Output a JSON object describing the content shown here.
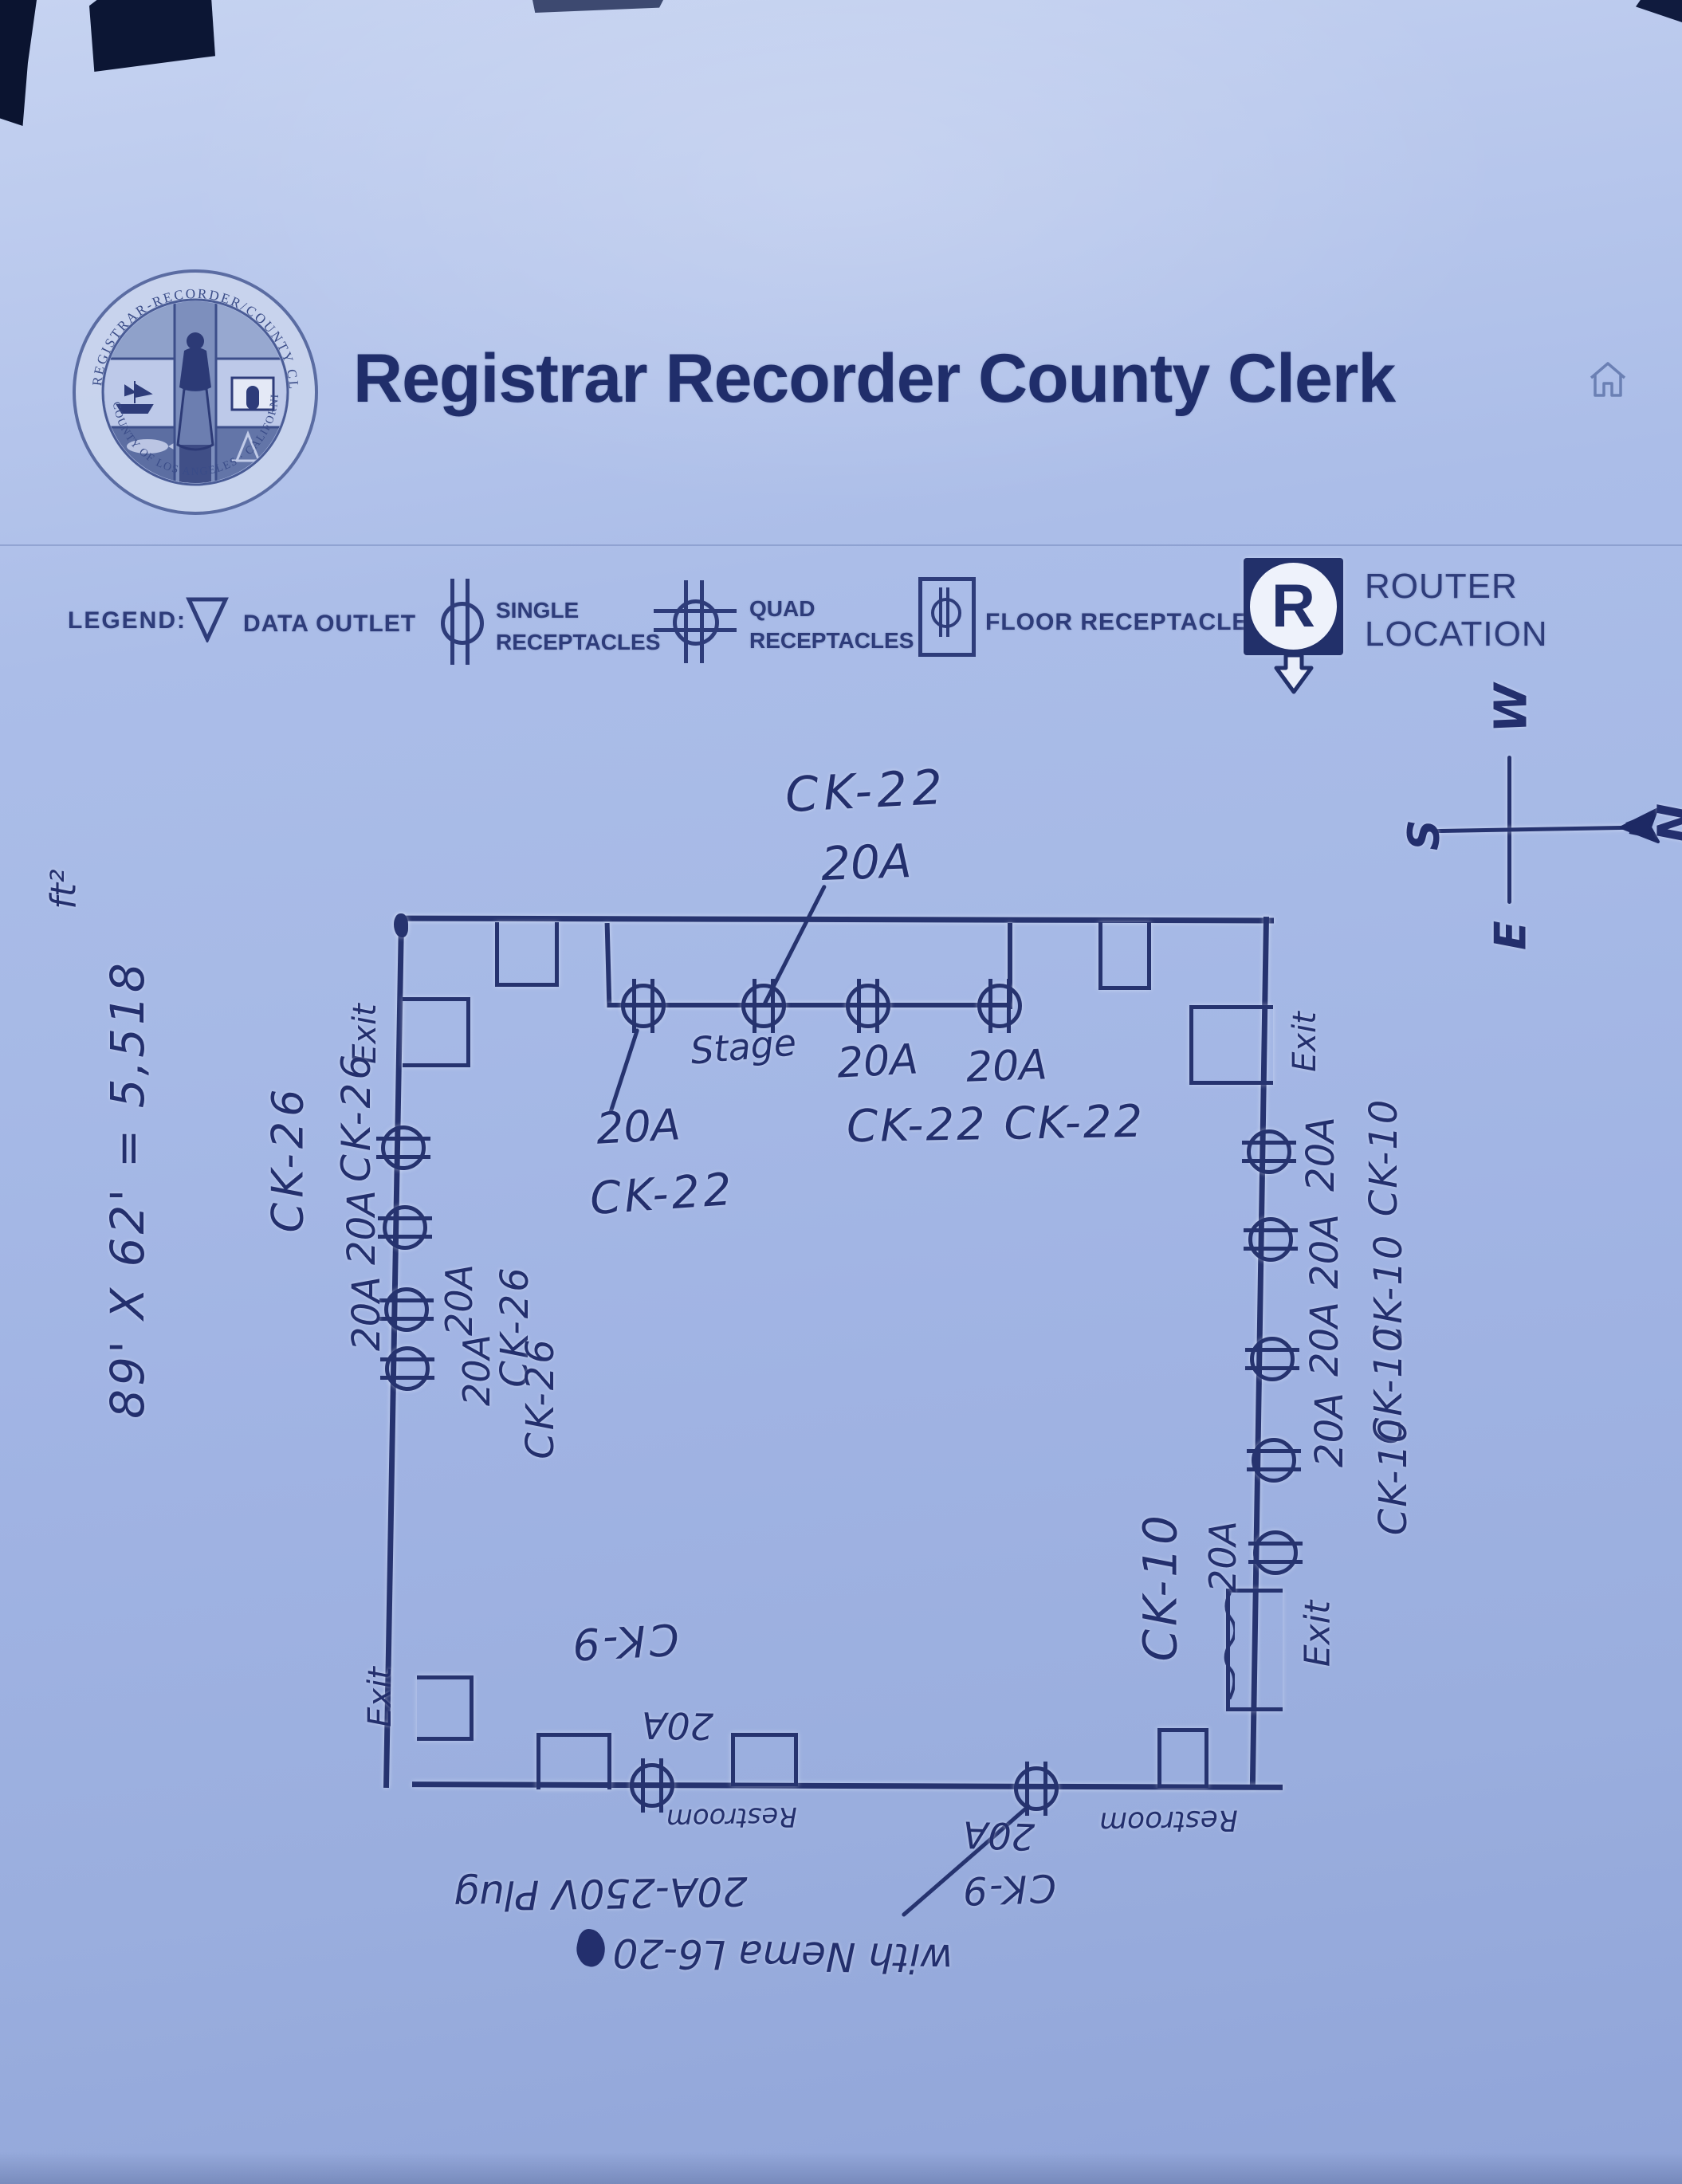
{
  "page": {
    "title": "Registrar Recorder County Clerk"
  },
  "seal": {
    "ring_top": "REGISTRAR-RECORDER/COUNTY CLERK",
    "ring_bottom": "COUNTY OF LOS ANGELES · CALIFORNIA"
  },
  "legend": {
    "label": "LEGEND:",
    "data_outlet": "DATA OUTLET",
    "single_line1": "SINGLE",
    "single_line2": "RECEPTACLES",
    "quad_line1": "QUAD",
    "quad_line2": "RECEPTACLES",
    "floor": "FLOOR RECEPTACLES",
    "router_letter": "R",
    "router_line1": "ROUTER",
    "router_line2": "LOCATION"
  },
  "compass": {
    "north": "N",
    "south": "S",
    "east": "E",
    "west": "W"
  },
  "plan": {
    "area_note": "89' X 62' = 5,518",
    "area_unit": "ft²",
    "stage_label": "Stage",
    "callout_circuit": "CK-22",
    "callout_amps": "20A",
    "stage_left_amps": "20A",
    "stage_left_circuit": "CK-22",
    "stage_amp3": "20A",
    "stage_amp4": "20A",
    "stage_circuits_right": "CK-22 CK-22",
    "exit_top_left": "Exit",
    "exit_bottom_left": "Exit",
    "exit_top_right": "Exit",
    "exit_bottom_right": "Exit",
    "left_circuit_a": "CK-26",
    "left_circuit_b": "CK-26",
    "left_amp_a": "20A",
    "left_amp_b": "20A",
    "left_inner_amp_a": "20A",
    "left_inner_amp_b": "20A",
    "left_inner_circuit_a": "CK-26",
    "left_inner_circuit_b": "CK-26",
    "right_amp_1": "20A",
    "right_circuit_1": "CK-10",
    "right_amp_2": "20A",
    "right_circuit_2": "CK-10",
    "right_amp_3": "20A",
    "right_circuit_3": "CK-10",
    "right_amp_4": "20A",
    "right_circuit_4": "CK-10",
    "right_amp_5": "20A",
    "right_circuit_5": "CK-10",
    "bottom_circuit_1": "CK-9",
    "bottom_amp_1": "20A",
    "restroom_left": "Restroom",
    "restroom_right": "Restroom",
    "bottom_amp_2": "20A",
    "bottom_circuit_2": "CK-9",
    "plug_note": "20A-250V Plug",
    "nema_note": "with Nema L6-20"
  }
}
